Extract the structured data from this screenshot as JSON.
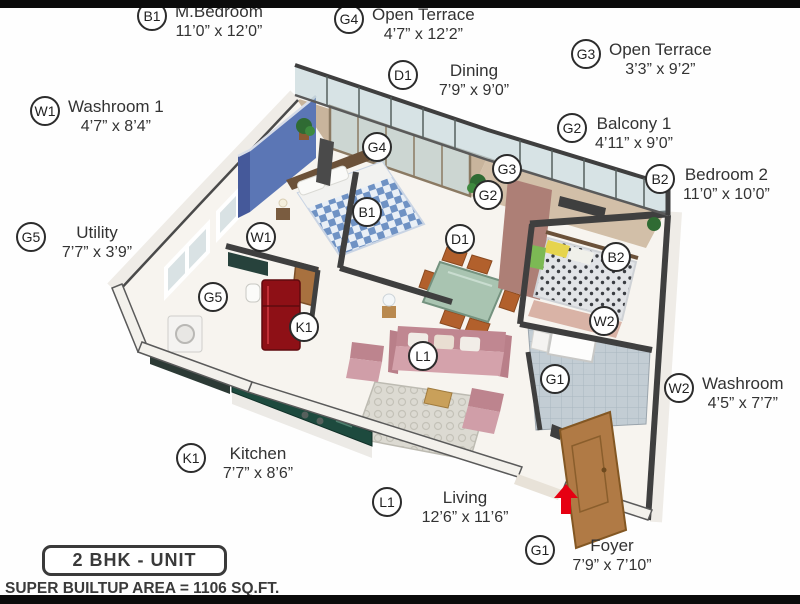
{
  "title_box": {
    "label": "2 BHK - UNIT"
  },
  "footer": {
    "area_text": "SUPER BUILTUP AREA = 1106 SQ.FT."
  },
  "rooms": [
    {
      "code": "B1",
      "name": "M.Bedroom",
      "dims": "11’0” x 12’0”"
    },
    {
      "code": "G4",
      "name": "Open Terrace",
      "dims": "4’7” x 12’2”"
    },
    {
      "code": "G3",
      "name": "Open Terrace",
      "dims": "3’3” x 9’2”"
    },
    {
      "code": "D1",
      "name": "Dining",
      "dims": "7’9” x 9’0”"
    },
    {
      "code": "W1",
      "name": "Washroom 1",
      "dims": "4’7” x 8’4”"
    },
    {
      "code": "G2",
      "name": "Balcony 1",
      "dims": "4’11” x 9’0”"
    },
    {
      "code": "B2",
      "name": "Bedroom 2",
      "dims": "11’0” x 10’0”"
    },
    {
      "code": "G5",
      "name": "Utility",
      "dims": "7’7” x 3’9”"
    },
    {
      "code": "W2",
      "name": "Washroom",
      "dims": "4’5” x 7’7”"
    },
    {
      "code": "K1",
      "name": "Kitchen",
      "dims": "7’7” x 8’6”"
    },
    {
      "code": "L1",
      "name": "Living",
      "dims": "12’6” x 11’6”"
    },
    {
      "code": "G1",
      "name": "Foyer",
      "dims": "7’9” x 7’10”"
    }
  ],
  "plan_markers": [
    "G4",
    "G3",
    "G2",
    "B1",
    "D1",
    "W1",
    "B2",
    "G5",
    "K1",
    "W2",
    "L1",
    "G1"
  ],
  "colors": {
    "accent_wall": "#5b76b5",
    "entry_arrow": "#e60012",
    "kitchen_counter": "#1d4a3e",
    "sofa": "#c98f9b",
    "wall": "#3f3f3f"
  }
}
